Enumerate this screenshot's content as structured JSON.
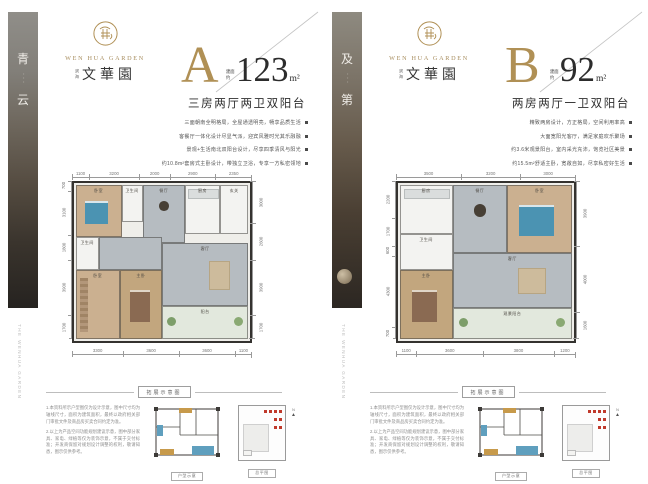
{
  "brand": {
    "name_en": "WEN HUA GARDEN",
    "name_cn": "文華園",
    "prefix_cn": "滨海"
  },
  "side_caption": "THE WENHUA GARDEN",
  "strip_dots": "···",
  "schematic": {
    "header": "拓展示意图",
    "plan_label": "户型示意",
    "site_label": "总平图",
    "compass": "N",
    "notes": [
      "1.本资料所示户型图仅为设计示意，图中尺寸均为轴线尺寸，面积为建筑面积，最终以政府相关部门审批文件及商品房买卖合同约定为准。",
      "2.以上为产品空间功能规划建议示意，图中部分家具、家电、绿植等仅为装饰示意，不属于交付标准；开发商保留对规划设计调整的权利，敬请知悉，图示仅供参考。"
    ],
    "legend": [
      {
        "label": "拓展面积",
        "color": "#5f9fbe"
      },
      {
        "label": "赠送面积",
        "color": "#c79a4b"
      }
    ]
  },
  "panels": [
    {
      "letter": "A",
      "strip_top": "青",
      "strip_bottom": "云",
      "area_prefix": "建面约",
      "area_value": "123",
      "area_unit": "m²",
      "subtitle": "三房两厅两卫双阳台",
      "bullets": [
        "三面朝南全明格局，全屋通透明亮，畅享品质生活",
        "客餐厅一体化设计尽显气派，迎宾风雅时光其乐融融",
        "景观+生活南北双阳台设计，尽享四季清风与阳光",
        "约10.8m²套房式主卧设计，带独立卫浴，专享一方私密领地"
      ],
      "plan": {
        "dims_top": [
          1100,
          3200,
          2000,
          2900,
          2350
        ],
        "dims_right": [
          3000,
          2600,
          3900,
          1700
        ],
        "dims_bottom": [
          3300,
          3600,
          3600,
          1100
        ],
        "dims_left": [
          700,
          3100,
          1800,
          3900,
          1700
        ],
        "rooms": [
          {
            "label": "卧室",
            "fill": "wood",
            "l": 1,
            "t": 1,
            "w": 26,
            "h": 33,
            "acc": "bed-blue"
          },
          {
            "label": "卫生间",
            "fill": "white",
            "l": 27,
            "t": 1,
            "w": 12,
            "h": 24
          },
          {
            "label": "餐厅",
            "fill": "tile",
            "l": 39,
            "t": 1,
            "w": 24,
            "h": 37,
            "acc": "table"
          },
          {
            "label": "厨房",
            "fill": "white",
            "l": 63,
            "t": 1,
            "w": 20,
            "h": 31,
            "acc": "counter"
          },
          {
            "label": "玄关",
            "fill": "white",
            "l": 83,
            "t": 1,
            "w": 16,
            "h": 31
          },
          {
            "label": "卫生间",
            "fill": "white",
            "l": 1,
            "t": 34,
            "w": 13,
            "h": 21
          },
          {
            "label": "",
            "fill": "tile",
            "l": 14,
            "t": 34,
            "w": 36,
            "h": 21
          },
          {
            "label": "卧室",
            "fill": "wood",
            "l": 1,
            "t": 55,
            "w": 25,
            "h": 44,
            "acc": "ward"
          },
          {
            "label": "主卧",
            "fill": "wood2",
            "l": 26,
            "t": 55,
            "w": 24,
            "h": 44,
            "acc": "bed-dark"
          },
          {
            "label": "客厅",
            "fill": "tile",
            "l": 50,
            "t": 38,
            "w": 49,
            "h": 40,
            "acc": "sofa"
          },
          {
            "label": "阳台",
            "fill": "balc",
            "l": 50,
            "t": 78,
            "w": 49,
            "h": 21,
            "acc": "plants"
          }
        ]
      }
    },
    {
      "letter": "B",
      "strip_top": "及",
      "strip_bottom": "第",
      "area_prefix": "建面约",
      "area_value": "92",
      "area_unit": "m²",
      "subtitle": "两房两厅一卫双阳台",
      "bullets": [
        "精致两房设计，方正格局，空间利用率高",
        "大面宽阳光客厅，满足家庭欢乐聚场",
        "约3.6米观景阳台，室内采光充沛，饱览社区美景",
        "约15.5m²舒适主卧，宽敞自如，尽享私密好生活"
      ],
      "plan": {
        "dims_top": [
          3500,
          3200,
          3000
        ],
        "dims_right": [
          3900,
          4000,
          1600
        ],
        "dims_bottom": [
          1100,
          3600,
          3800,
          1200
        ],
        "dims_left": [
          2200,
          1700,
          600,
          4300,
          700
        ],
        "rooms": [
          {
            "label": "厨房",
            "fill": "white",
            "l": 1,
            "t": 1,
            "w": 30,
            "h": 31,
            "acc": "counter"
          },
          {
            "label": "餐厅",
            "fill": "tile",
            "l": 31,
            "t": 1,
            "w": 31,
            "h": 43,
            "acc": "table"
          },
          {
            "label": "卧室",
            "fill": "wood",
            "l": 62,
            "t": 1,
            "w": 37,
            "h": 43,
            "acc": "bed-blue"
          },
          {
            "label": "卫生间",
            "fill": "white",
            "l": 1,
            "t": 32,
            "w": 30,
            "h": 23
          },
          {
            "label": "客厅",
            "fill": "tile",
            "l": 31,
            "t": 44,
            "w": 68,
            "h": 35,
            "acc": "sofa"
          },
          {
            "label": "主卧",
            "fill": "wood2",
            "l": 1,
            "t": 55,
            "w": 30,
            "h": 44,
            "acc": "bed-dark"
          },
          {
            "label": "观景阳台",
            "fill": "balc",
            "l": 31,
            "t": 79,
            "w": 68,
            "h": 20,
            "acc": "plants"
          }
        ]
      }
    }
  ]
}
